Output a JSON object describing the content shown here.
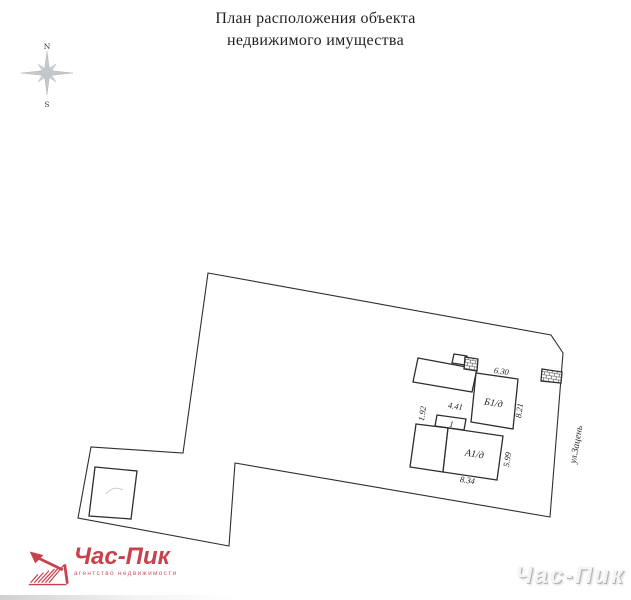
{
  "header": {
    "title_line1": "План расположения объекта",
    "title_line2": "недвижимого имущества"
  },
  "compass": {
    "north": "N",
    "south": "S"
  },
  "plan": {
    "street": "ул.Зацень",
    "building_b1_label": "Б1/д",
    "building_a1_label": "А1/д",
    "annex_label": "1",
    "dim_b1_width": "6.30",
    "dim_b1_depth": "8.21",
    "dim_annex_width": "4.41",
    "dim_annex_depth": "1.92",
    "dim_a1_depth": "5.99",
    "dim_a1_width": "8.34"
  },
  "branding": {
    "logo_text": "Час-Пик",
    "logo_tagline": "агентство недвижимости",
    "logo_color": "#c8414c",
    "watermark_text": "Час-Пик"
  }
}
